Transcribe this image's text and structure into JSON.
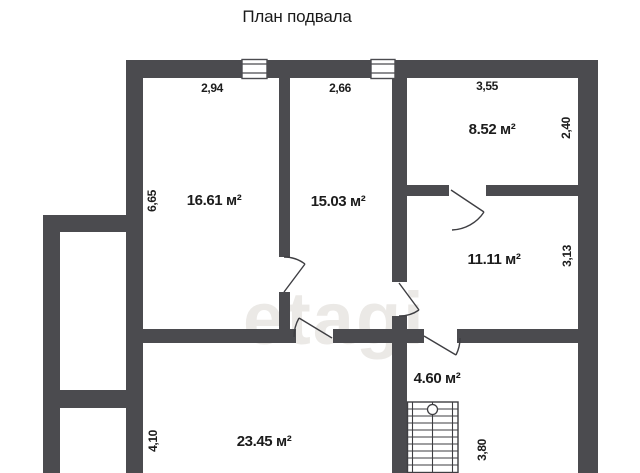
{
  "title": "План подвала",
  "watermark": "etagi",
  "rooms": {
    "r1661": {
      "area": "16.61 м²",
      "width": "2,94",
      "height": "6,65"
    },
    "r1503": {
      "area": "15.03 м²",
      "width": "2,66"
    },
    "r852": {
      "area": "8.52 м²",
      "width": "3,55",
      "height": "2,40"
    },
    "r1111": {
      "area": "11.11 м²",
      "height": "3,13"
    },
    "r460": {
      "area": "4.60 м²"
    },
    "r2345": {
      "area": "23.45 м²",
      "height": "4,10"
    },
    "r380": {
      "height": "3,80"
    }
  },
  "colors": {
    "wall": "#4b4b4f",
    "text": "#1c1c1c",
    "watermark": "#ebe9e6",
    "background": "#ffffff"
  }
}
